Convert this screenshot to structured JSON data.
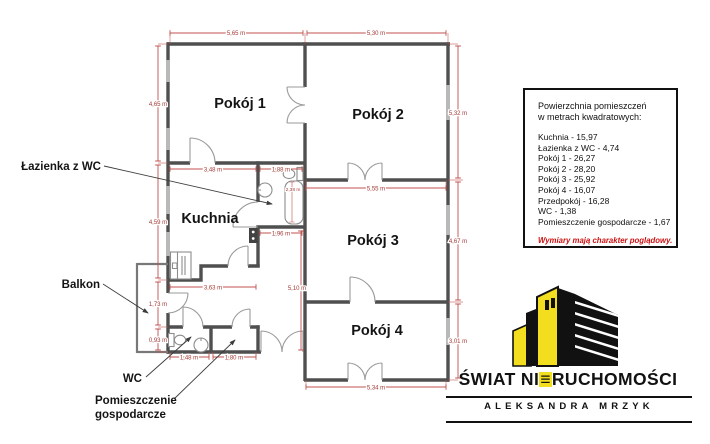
{
  "colors": {
    "wall": "#4f4f4f",
    "dimension_red": "#c0504d",
    "dimension_text_red": "#a33a36",
    "logo_yellow": "#f2dd1f",
    "note_red": "#cc1111"
  },
  "plan": {
    "rooms": {
      "pokoj1": "Pokój 1",
      "pokoj2": "Pokój 2",
      "pokoj3": "Pokój 3",
      "pokoj4": "Pokój 4",
      "kuchnia": "Kuchnia"
    },
    "labels": {
      "lazienka": "Łazienka z WC",
      "balkon": "Balkon",
      "wc": "WC",
      "gospodarcze1": "Pomieszczenie",
      "gospodarcze2": "gospodarcze"
    },
    "dimensions": {
      "top_left": "5,65 m",
      "top_right": "5,30 m",
      "left_upper": "4,65 m",
      "left_mid": "4,59 m",
      "left_lower": "1,73 m",
      "left_bottom": "0,93 m",
      "right_upper": "5,32 m",
      "right_mid": "4,67 m",
      "right_lower": "3,01 m",
      "kitchen_top": "3,48 m",
      "kitchen_bottom": "3,63 m",
      "bath_top": "1,88 m",
      "bath_bottom": "1,96 m",
      "bath_tub": "2,38 m",
      "room3_top": "5,55 m",
      "hall_vertical": "5,10 m",
      "wc_width": "1,48 m",
      "storage_width": "1,80 m",
      "room4_bottom": "5,34 m"
    }
  },
  "legend": {
    "title1": "Powierzchnia pomieszczeń",
    "title2": "w metrach kwadratowych:",
    "items": [
      "Kuchnia - 15,97",
      "Łazienka z WC - 4,74",
      "Pokój 1 - 26,27",
      "Pokój 2 - 28,20",
      "Pokój 3 - 25,92",
      "Pokój 4 - 16,07",
      "Przedpokój - 16,28",
      "WC - 1,38",
      "Pomieszczenie gospodarcze - 1,67"
    ],
    "note": "Wymiary mają charakter poglądowy."
  },
  "logo": {
    "name_pre": "ŚWIAT NI",
    "name_e": "≡",
    "name_post": "RUCHOMOŚCI",
    "subtitle": "ALEKSANDRA MRZYK"
  }
}
